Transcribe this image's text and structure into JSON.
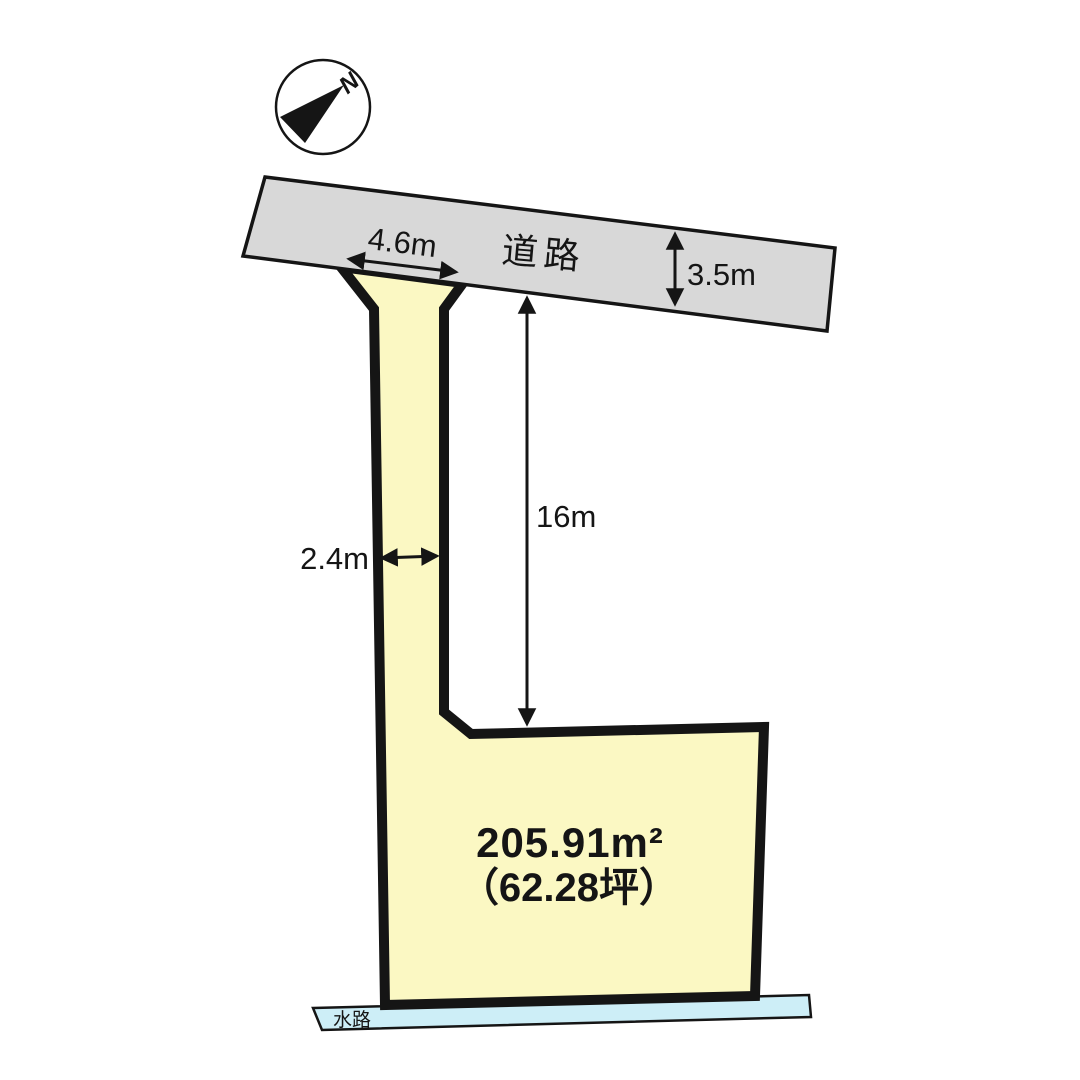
{
  "colors": {
    "background": "#ffffff",
    "road_fill": "#d8d8d8",
    "parcel_fill": "#fbf8c3",
    "waterway_fill": "#cdeef7",
    "line": "#151515"
  },
  "compass": {
    "north_label": "N"
  },
  "road": {
    "name_label": "道路",
    "width_label": "3.5m"
  },
  "parcel": {
    "frontage_label": "4.6m",
    "flagpole_width_label": "2.4m",
    "flagpole_depth_label": "16m",
    "area_sqm_label": "205.91m²",
    "area_tsubo_label": "（62.28坪）"
  },
  "waterway": {
    "name_label": "水路"
  }
}
